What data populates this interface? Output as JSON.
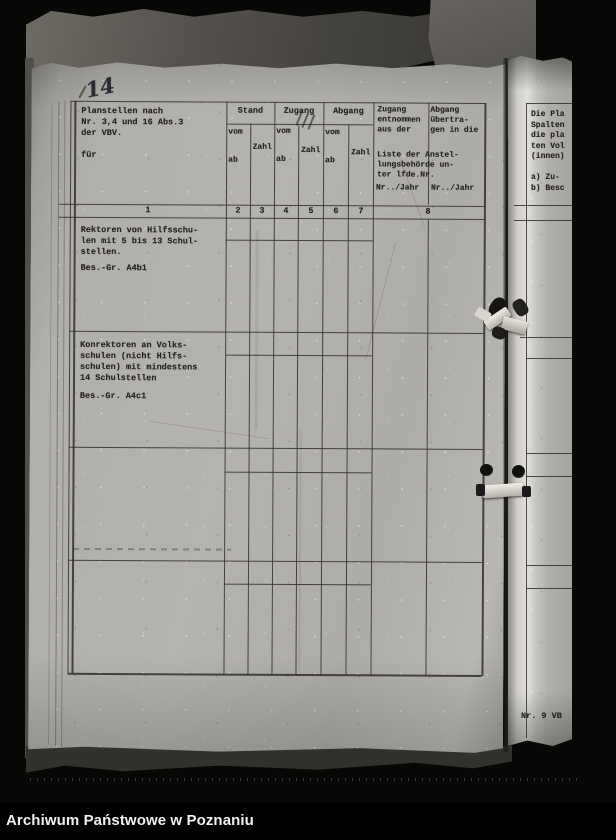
{
  "photo": {
    "handwritten_page_number": "14",
    "caption_bar": "Archiwum Państwowe w Poznaniu"
  },
  "table": {
    "header": {
      "col1": "Planstellen nach\nNr. 3,4 und 16 Abs.3\nder VBV.\n\nfür",
      "stand": "Stand",
      "zugang": "Zugang",
      "abgang": "Abgang",
      "vom": "vom",
      "ab": "ab",
      "zahl": "Zahl",
      "col8_zugang": "Zugang\nentnommen\naus der",
      "col8_abgang": "Abgang\nübertra-\ngen in die",
      "col8_liste": "Liste der Anstel-\nlungsbehörde un-\nter lfde.Nr.",
      "col8_nr_jahr_left": "Nr../Jahr",
      "col8_nr_jahr_right": "Nr../Jahr"
    },
    "column_numbers": [
      "1",
      "2",
      "3",
      "4",
      "5",
      "6",
      "7",
      "8"
    ],
    "rows": [
      {
        "description": "Rektoren von Hilfsschu-\nlen mit 5 bis 13 Schul-\nstellen.",
        "grade": "Bes.-Gr. A4b1"
      },
      {
        "description": "Konrektoren an Volks-\nschulen (nicht Hilfs-\nschulen) mit mindestens\n14 Schulstellen",
        "grade": "Bes.-Gr. A4c1"
      }
    ]
  },
  "adjacent_page": {
    "text_fragment": "Die Pla\nSpalten\ndie pla\nten Vol\n(innen)\n\na) Zu-\nb) Besc",
    "footer_label": "Nr. 9 VB"
  }
}
